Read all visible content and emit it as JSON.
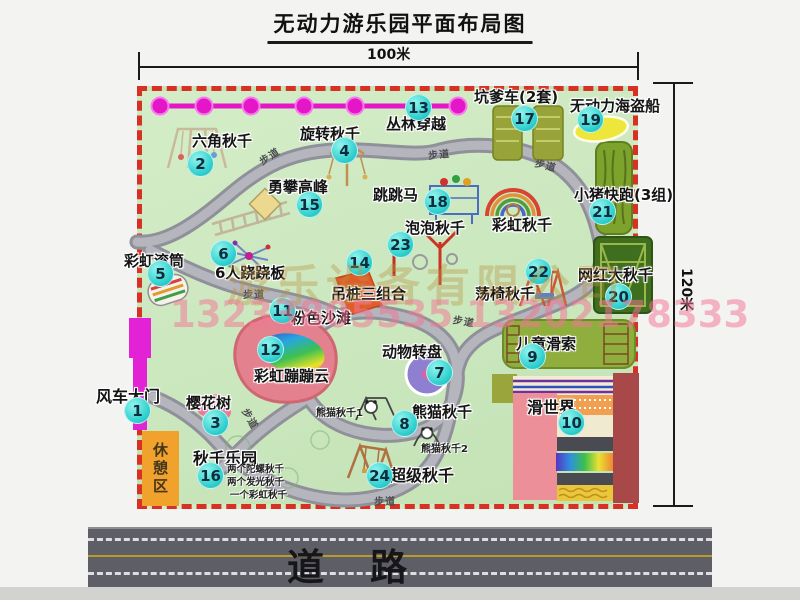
{
  "title": "无动力游乐园平面布局图",
  "dimensions": {
    "width": "100米",
    "height": "120米"
  },
  "road": {
    "label": "道路"
  },
  "watermark": {
    "company": "游乐设备有限公司",
    "phones": "13233805535 13202178333"
  },
  "path_label": "步道",
  "area_labels": {
    "rest": "休憩区",
    "rainbow_swing": "彩虹秋千",
    "panda1": "熊猫秋千1",
    "panda2": "熊猫秋千2"
  },
  "attractions": [
    {
      "num": "1",
      "label": "风车大门"
    },
    {
      "num": "2",
      "label": "六角秋千"
    },
    {
      "num": "3",
      "label": "樱花树"
    },
    {
      "num": "4",
      "label": "旋转秋千"
    },
    {
      "num": "5",
      "label": "彩虹滚筒"
    },
    {
      "num": "6",
      "label": "6人跷跷板"
    },
    {
      "num": "7",
      "label": "动物转盘"
    },
    {
      "num": "8",
      "label": "熊猫秋千"
    },
    {
      "num": "9",
      "label": "儿童滑索"
    },
    {
      "num": "10",
      "label": "滑世界"
    },
    {
      "num": "11",
      "label": "粉色沙滩"
    },
    {
      "num": "12",
      "label": "彩虹蹦蹦云"
    },
    {
      "num": "13",
      "label": "丛林穿越"
    },
    {
      "num": "14",
      "label": "吊桩三组合"
    },
    {
      "num": "15",
      "label": "勇攀高峰"
    },
    {
      "num": "16",
      "label": "秋千乐园",
      "notes": [
        "两个陀螺秋千",
        "两个发光秋千",
        "一个彩虹秋千"
      ]
    },
    {
      "num": "17",
      "label": "坑爹车(2套)"
    },
    {
      "num": "18",
      "label": "跳跳马"
    },
    {
      "num": "19",
      "label": "无动力海盗船"
    },
    {
      "num": "20",
      "label": "网红大秋千"
    },
    {
      "num": "21",
      "label": "小猪快跑(3组)"
    },
    {
      "num": "22",
      "label": "荡椅秋千"
    },
    {
      "num": "23",
      "label": "泡泡秋千"
    },
    {
      "num": "24",
      "label": "超级秋千"
    }
  ],
  "colors": {
    "badge": "#2fd0cf",
    "border_red": "#d83022",
    "map_green": "#cae6bd",
    "zipline_magenta": "#e515c8",
    "road_gray": "#5e5e66",
    "rest_orange": "#f0a22c"
  }
}
